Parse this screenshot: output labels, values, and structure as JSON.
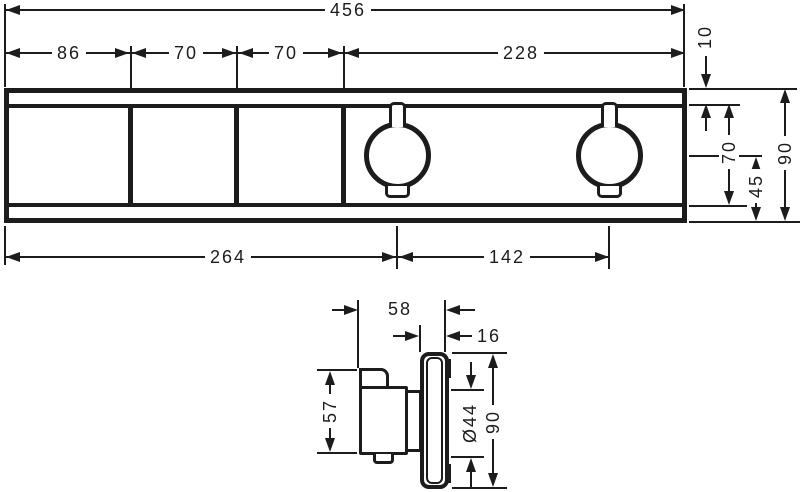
{
  "canvas": {
    "background": "#ffffff",
    "line_color": "#1c1c1c"
  },
  "front_view": {
    "dim_total_width": "456",
    "dim_sections": [
      "86",
      "70",
      "70",
      "228"
    ],
    "dim_top_strip": "10",
    "dim_inner_height": "70",
    "dim_center_to_bottom": "45",
    "dim_total_height": "90",
    "dim_left_to_handle": "264",
    "dim_handle_spacing": "142"
  },
  "side_view": {
    "dim_total_depth": "58",
    "dim_escutcheon_depth": "16",
    "dim_handle_height": "57",
    "dim_handle_diameter": "Ø44",
    "dim_escutcheon_height": "90"
  }
}
